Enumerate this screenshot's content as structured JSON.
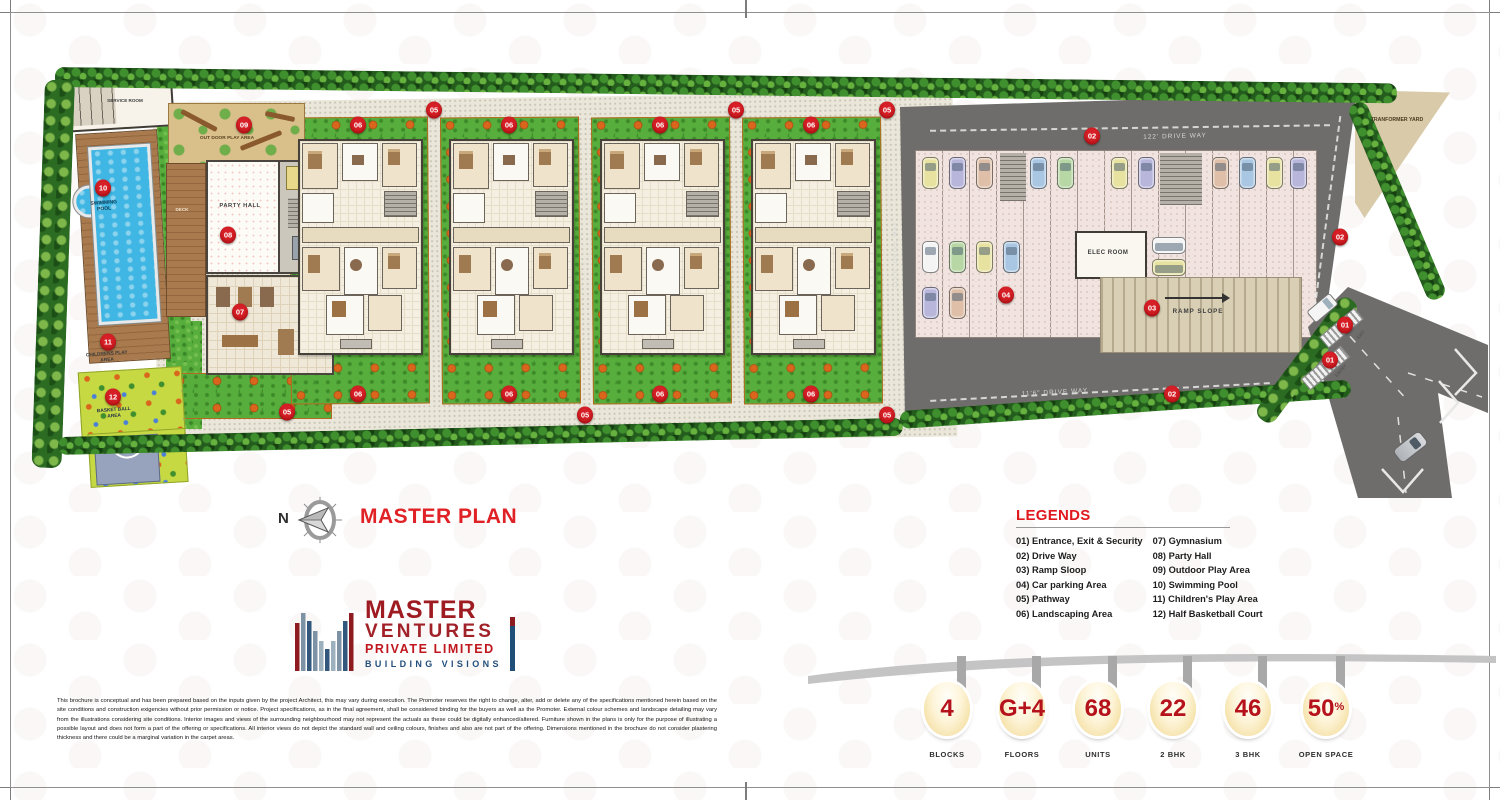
{
  "title": {
    "compass_n": "N",
    "text": "MASTER PLAN"
  },
  "legends": {
    "title": "LEGENDS",
    "col1": [
      "01) Entrance, Exit & Security",
      "02) Drive Way",
      "03) Ramp Sloop",
      "04) Car parking Area",
      "05) Pathway",
      "06) Landscaping Area"
    ],
    "col2": [
      "07) Gymnasium",
      "08) Party Hall",
      "09) Outdoor Play Area",
      "10) Swimming Pool",
      "11) Children's Play Area",
      "12) Half Basketball Court"
    ]
  },
  "logo": {
    "name": "MASTER",
    "line2": "VENTURES",
    "line3": "PRIVATE LIMITED",
    "tagline": "BUILDING VISIONS"
  },
  "disclaimer": "This brochure is conceptual and has been prepared based on the inputs given by the project Architect, this may vary during execution. The Promoter reserves the right to change, alter, add or delete any of the specifications mentioned herein based on the site conditions and construction exigencies without prior permission or notice. Project specifications, as in the final agreement, shall be considered binding for the buyers as well as the Promoter. External colour schemes and landscape detailing may vary from the illustrations considering site conditions. Interior images and views of the surrounding neighbourhood may not represent the actuals as these could be digitally enhanced/altered. Furniture shown in the plans is only for the purpose of illustrating a possible layout and does not form a part of the offering or specifications. All interior views do not depict the standard wall and ceiling colours, finishes and also are not part of the offering. Dimensions mentioned in the brochure do not consider plastering thickness and there could be a marginal variation in the carpet areas.",
  "stats": [
    {
      "value": "4",
      "label": "BLOCKS"
    },
    {
      "value": "G+4",
      "label": "FLOORS"
    },
    {
      "value": "68",
      "label": "UNITS"
    },
    {
      "value": "22",
      "label": "2 BHK"
    },
    {
      "value": "46",
      "label": "3 BHK"
    },
    {
      "value": "50%",
      "label": "OPEN SPACE"
    }
  ],
  "plan": {
    "labels": {
      "service_room": "SERVICE ROOM",
      "swimming_pool": "SWIMMING POOL",
      "childrens_play": "CHILDRENS PLAY AREA",
      "basketball": "BASKET BALL AREA",
      "outdoor_play": "OUT DOOR PLAY AREA",
      "party_hall": "PARTY HALL",
      "deck": "DECK",
      "elec_room": "ELEC ROOM",
      "ramp_slope": "RAMP SLOPE",
      "transformer_yard": "TRANFORMER YARD",
      "driveway_top": "122' DRIVE WAY",
      "driveway_left": "115'6\" DRIVE WAY",
      "driveway_bottom": "11'6\" DRIVE WAY",
      "entry": "ENTRY",
      "exit": "EXIT"
    },
    "markers": [
      {
        "n": "01",
        "x": 1345,
        "y": 325
      },
      {
        "n": "01",
        "x": 1330,
        "y": 360
      },
      {
        "n": "02",
        "x": 1092,
        "y": 136
      },
      {
        "n": "02",
        "x": 1340,
        "y": 237
      },
      {
        "n": "02",
        "x": 1172,
        "y": 394
      },
      {
        "n": "03",
        "x": 1152,
        "y": 308
      },
      {
        "n": "04",
        "x": 1006,
        "y": 295
      },
      {
        "n": "05",
        "x": 434,
        "y": 110
      },
      {
        "n": "05",
        "x": 736,
        "y": 110
      },
      {
        "n": "05",
        "x": 887,
        "y": 110
      },
      {
        "n": "05",
        "x": 287,
        "y": 412
      },
      {
        "n": "05",
        "x": 585,
        "y": 415
      },
      {
        "n": "05",
        "x": 887,
        "y": 415
      },
      {
        "n": "06",
        "x": 358,
        "y": 125
      },
      {
        "n": "06",
        "x": 509,
        "y": 125
      },
      {
        "n": "06",
        "x": 660,
        "y": 125
      },
      {
        "n": "06",
        "x": 811,
        "y": 125
      },
      {
        "n": "06",
        "x": 358,
        "y": 394
      },
      {
        "n": "06",
        "x": 509,
        "y": 394
      },
      {
        "n": "06",
        "x": 660,
        "y": 394
      },
      {
        "n": "06",
        "x": 811,
        "y": 394
      },
      {
        "n": "07",
        "x": 240,
        "y": 312
      },
      {
        "n": "08",
        "x": 228,
        "y": 235
      },
      {
        "n": "09",
        "x": 244,
        "y": 125
      },
      {
        "n": "10",
        "x": 103,
        "y": 188
      },
      {
        "n": "11",
        "x": 108,
        "y": 342
      },
      {
        "n": "12",
        "x": 113,
        "y": 397
      }
    ]
  },
  "colors": {
    "marker_red": "#d61f26",
    "title_red": "#e02226",
    "logo_maroon": "#9e1b21",
    "logo_blue": "#1f4e79",
    "stat_red": "#b5121b",
    "grass_green": "#58ae3c",
    "asphalt": "#6f6d6b"
  }
}
